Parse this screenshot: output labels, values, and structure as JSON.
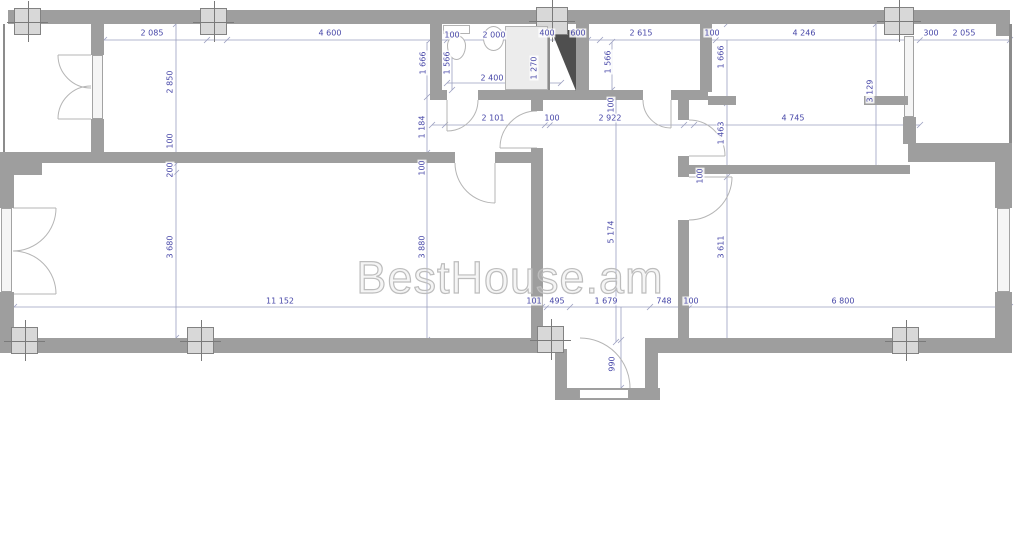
{
  "watermark": {
    "text": "BestHouse.am"
  },
  "colors": {
    "wall": "#9e9e9e",
    "shaft": "#4f4f4f",
    "dimension_text": "#4747a8",
    "dimension_line": "#9ba0c0",
    "watermark": "#bdbdbd",
    "column_fill": "#d8d8d8",
    "fixture_fill": "#ececec",
    "window_fill": "#f5f5f5"
  },
  "dimension_labels": [
    {
      "text": "2 085",
      "x": 152,
      "y": 33,
      "o": "h"
    },
    {
      "text": "4 600",
      "x": 330,
      "y": 33,
      "o": "h"
    },
    {
      "text": "100",
      "x": 452,
      "y": 35,
      "o": "h"
    },
    {
      "text": "2 000",
      "x": 494,
      "y": 35,
      "o": "h"
    },
    {
      "text": "400",
      "x": 547,
      "y": 33,
      "o": "h"
    },
    {
      "text": "600",
      "x": 578,
      "y": 33,
      "o": "h"
    },
    {
      "text": "2 615",
      "x": 641,
      "y": 33,
      "o": "h"
    },
    {
      "text": "100",
      "x": 712,
      "y": 33,
      "o": "h"
    },
    {
      "text": "4 246",
      "x": 804,
      "y": 33,
      "o": "h"
    },
    {
      "text": "300",
      "x": 931,
      "y": 33,
      "o": "h"
    },
    {
      "text": "2 055",
      "x": 964,
      "y": 33,
      "o": "h"
    },
    {
      "text": "2 400",
      "x": 492,
      "y": 78,
      "o": "h"
    },
    {
      "text": "2 101",
      "x": 493,
      "y": 118,
      "o": "h"
    },
    {
      "text": "100",
      "x": 552,
      "y": 118,
      "o": "h"
    },
    {
      "text": "2 922",
      "x": 610,
      "y": 118,
      "o": "h"
    },
    {
      "text": "4 745",
      "x": 793,
      "y": 118,
      "o": "h"
    },
    {
      "text": "11 152",
      "x": 280,
      "y": 301,
      "o": "h"
    },
    {
      "text": "101",
      "x": 534,
      "y": 301,
      "o": "h"
    },
    {
      "text": "495",
      "x": 557,
      "y": 301,
      "o": "h"
    },
    {
      "text": "1 679",
      "x": 606,
      "y": 301,
      "o": "h"
    },
    {
      "text": "748",
      "x": 664,
      "y": 301,
      "o": "h"
    },
    {
      "text": "100",
      "x": 691,
      "y": 301,
      "o": "h"
    },
    {
      "text": "6 800",
      "x": 843,
      "y": 301,
      "o": "h"
    },
    {
      "text": "2 850",
      "x": 170,
      "y": 82,
      "o": "v"
    },
    {
      "text": "100",
      "x": 170,
      "y": 141,
      "o": "v"
    },
    {
      "text": "200",
      "x": 170,
      "y": 170,
      "o": "v"
    },
    {
      "text": "3 680",
      "x": 170,
      "y": 247,
      "o": "v"
    },
    {
      "text": "1 666",
      "x": 423,
      "y": 63,
      "o": "v"
    },
    {
      "text": "1 566",
      "x": 447,
      "y": 63,
      "o": "v"
    },
    {
      "text": "1 270",
      "x": 534,
      "y": 68,
      "o": "v"
    },
    {
      "text": "1 566",
      "x": 608,
      "y": 62,
      "o": "v"
    },
    {
      "text": "1 666",
      "x": 721,
      "y": 57,
      "o": "v"
    },
    {
      "text": "3 129",
      "x": 870,
      "y": 91,
      "o": "v"
    },
    {
      "text": "1 184",
      "x": 422,
      "y": 127,
      "o": "v"
    },
    {
      "text": "100",
      "x": 422,
      "y": 168,
      "o": "v"
    },
    {
      "text": "3 880",
      "x": 422,
      "y": 247,
      "o": "v"
    },
    {
      "text": "100",
      "x": 611,
      "y": 105,
      "o": "v"
    },
    {
      "text": "5 174",
      "x": 611,
      "y": 232,
      "o": "v"
    },
    {
      "text": "1 463",
      "x": 721,
      "y": 133,
      "o": "v"
    },
    {
      "text": "100",
      "x": 700,
      "y": 176,
      "o": "v"
    },
    {
      "text": "3 611",
      "x": 721,
      "y": 247,
      "o": "v"
    },
    {
      "text": "990",
      "x": 612,
      "y": 364,
      "o": "v"
    }
  ]
}
